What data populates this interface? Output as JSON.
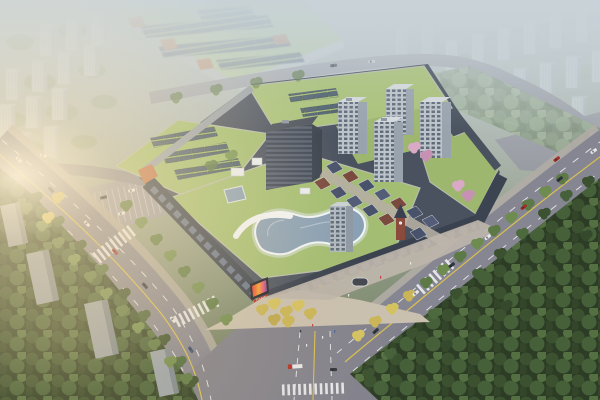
{
  "scene": {
    "description": "Aerial architectural rendering at dusk of a mixed-use shopping mall development with landscaped green roofs, rooftop solar arrays, an organic pool-shaped skylight, residential towers, a European-style retail street with clock tower, tree-lined avenues with traffic, a surface parking lot, hazy residential districts behind, a dense forest park at lower right and warm sun glare from the left",
    "landmarks": [
      "industrial plant building with rooftop solar panels",
      "shopping mall podium with green roofs",
      "rooftop solar panel arrays",
      "organic pool-shaped rooftop skylight",
      "white arched rooftop canopy",
      "corner LED advertising screen with red sign",
      "five residential high-rise towers",
      "low-rise retail street with clock tower",
      "surface parking lot",
      "west avenue with lane markings and cars",
      "east avenue along forest park",
      "large road intersection",
      "pedestrian plaza with golden autumn trees",
      "pink blossom trees at east courtyard",
      "dense forest park",
      "hazy residential slabs in background",
      "sun glare upper left"
    ]
  },
  "palette": {
    "green_roof": "#a3bd72",
    "green_roof_light": "#b2c98c",
    "solar_panel": "#4a5b70",
    "road": "#868693",
    "sidewalk": "#aeaaa3",
    "plaza": "#c9c0b0",
    "esplanade": "#bdb5ab",
    "parking": "#9d9da6",
    "mall_facade": "#3a4250",
    "storefront": "#77849c",
    "accent_orange": "#c0744c",
    "pool_glass": "#8aa0b4",
    "forest": "#2c3c25",
    "canopy_light_base": "#6f8462",
    "tree_green": "#5d7a46",
    "tree_yellow": "#c9b557",
    "tree_pink": "#d9a9c5",
    "tower_face": "#bcc3ca",
    "tower_side": "#99a3ae",
    "bg_building": "#ccd4da",
    "slab_dark_face": "#9aa4ae",
    "office_slab": "#596273",
    "retail_roof": "#49526b",
    "retail_roof_warm": "#7a4a3e",
    "screen_red": "#b82e22",
    "lane_yellow": "#d8c050",
    "lane_white": "#eef0f2",
    "haze": "#c9d3d8",
    "glare": "#fff3d8",
    "warm_tint": "#e8c788"
  }
}
